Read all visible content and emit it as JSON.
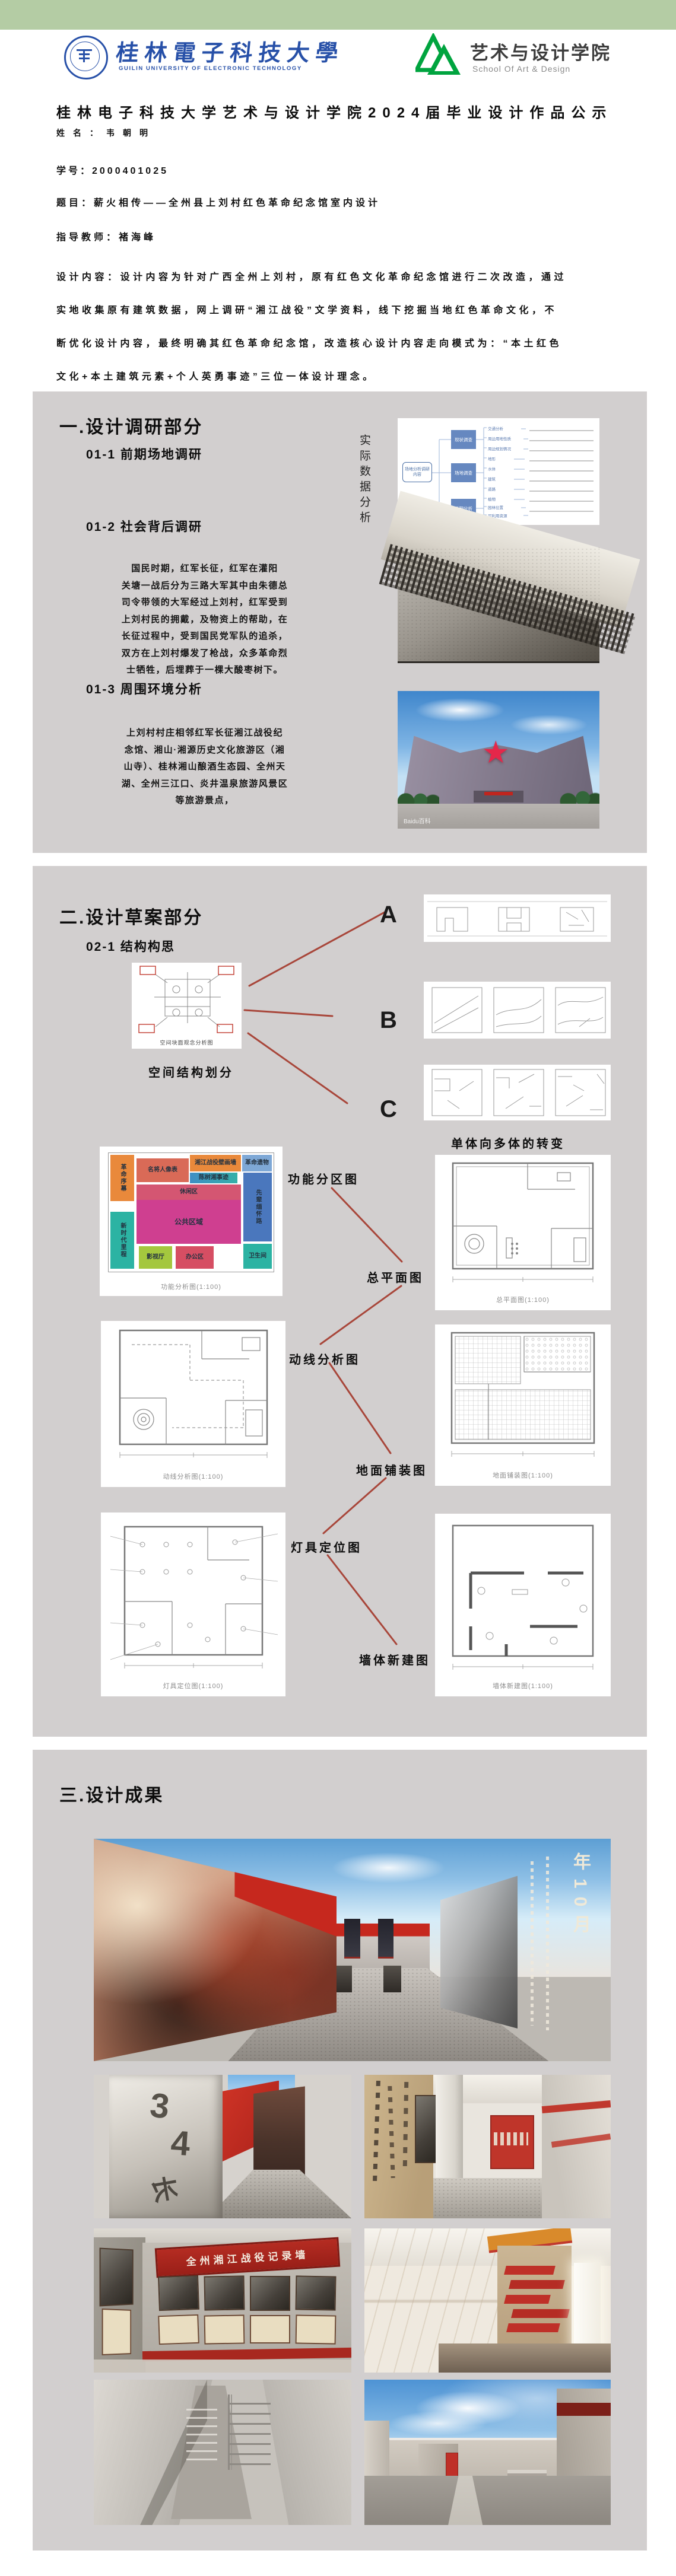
{
  "colors": {
    "green_bar": "#b4cca4",
    "panel_gray": "#d2cfcf",
    "connector_red": "#a8463a",
    "university_blue": "#2750a8",
    "school_green": "#00a43f",
    "banner_red": "#b02a22",
    "star_red": "#e5274a"
  },
  "header": {
    "university": {
      "cn": "桂林電子科技大學",
      "en": "GUILIN UNIVERSITY OF ELECTRONIC TECHNOLOGY"
    },
    "school": {
      "cn": "艺术与设计学院",
      "en": "School Of Art & Design"
    }
  },
  "intro": {
    "title": "桂林电子科技大学艺术与设计学院2024届毕业设计作品公示",
    "name": "姓名：韦朝明",
    "student_id": "学号：2000401025",
    "topic": "题目：薪火相传——全州县上刘村红色革命纪念馆室内设计",
    "advisor": "指导教师：褚海峰",
    "content": "设计内容：设计内容为针对广西全州上刘村，原有红色文化革命纪念馆进行二次改造，通过\n实地收集原有建筑数据，网上调研“湘江战役”文学资料，线下挖掘当地红色革命文化，不\n断优化设计内容，最终明确其红色革命纪念馆，改造核心设计内容走向模式为：“本土红色\n文化+本土建筑元素+个人英勇事迹”三位一体设计理念。"
  },
  "s1": {
    "heading": "一.设计调研部分",
    "sub1": "01-1 前期场地调研",
    "vertical_label": "实际数据分析",
    "mindmap": {
      "root": "场地分析调研内容",
      "nodes": [
        "现状调查",
        "场地调查",
        "后期分析"
      ],
      "branches": [
        "交通分析",
        "周边用地性质",
        "周边规划情况",
        "地形",
        "水体",
        "建筑",
        "道路",
        "植物",
        "园林位置",
        "可利用资源"
      ]
    },
    "sub2": "01-2 社会背后调研",
    "para1": "国民时期，红军长征，红军在灌阳\n关塘一战后分为三路大军其中由朱德总\n司令带领的大军经过上刘村，红军受到\n上刘村民的拥戴，及物资上的帮助，在\n长征过程中，受到国民党军队的追杀，\n双方在上刘村爆发了枪战，众多革命烈\n士牺牲，后埋葬于一棵大酸枣树下。",
    "sub3": "01-3 周围环境分析",
    "para2": "上刘村村庄相邻红军长征湘江战役纪\n念馆、湘山·湘源历史文化旅游区（湘\n山寺）、桂林湘山酿酒生态园、全州天\n湖、全州三江口、炎井温泉旅游风景区\n等旅游景点，",
    "watermark": "Baidu百科"
  },
  "s2": {
    "heading": "二.设计草案部分",
    "sub": "02-1 结构构思",
    "sketch_caption": "空间块面观念分析图",
    "caption_structure": "空间结构划分",
    "letters": [
      "A",
      "B",
      "C"
    ],
    "caption_transform": "单体向多体的转变",
    "labels": {
      "zoning": "功能分区图",
      "master": "总平面图",
      "circulation": "动线分析图",
      "paving": "地面铺装图",
      "lighting": "灯具定位图",
      "wall": "墙体新建图"
    },
    "plan_captions": {
      "zoning": "功能分析图(1:100)",
      "master": "总平面图(1:100)",
      "circulation": "动线分析图(1:100)",
      "paving": "地面铺装图(1:100)",
      "lighting": "灯具定位图(1:100)",
      "wall": "墙体新建图(1:100)"
    },
    "zones": [
      {
        "label": "革命序幕",
        "color": "#e9893b"
      },
      {
        "label": "名将人像表",
        "color": "#d96a57"
      },
      {
        "label": "湘江战役壁画墙",
        "color": "#e9893b"
      },
      {
        "label": "陈树湘事迹",
        "color": "#3f8ec4"
      },
      {
        "label": "革命遗物",
        "color": "#7ea8d6"
      },
      {
        "label": "先辈缅怀路",
        "color": "#4a77bd"
      },
      {
        "label": "休闲区",
        "color": "#d45672"
      },
      {
        "label": "公共区域",
        "color": "#cf3f90"
      },
      {
        "label": "新时代里程",
        "color": "#2cb3a3"
      },
      {
        "label": "影视厅",
        "color": "#a4c73e"
      },
      {
        "label": "办公区",
        "color": "#d64e63"
      },
      {
        "label": "卫生间",
        "color": "#2cb3a3"
      }
    ]
  },
  "s3": {
    "heading": "三.设计成果",
    "banner": "全州湘江战役记录墙",
    "stele_chars": [
      "3",
      "4",
      "长"
    ],
    "wall_text": "年10月"
  }
}
